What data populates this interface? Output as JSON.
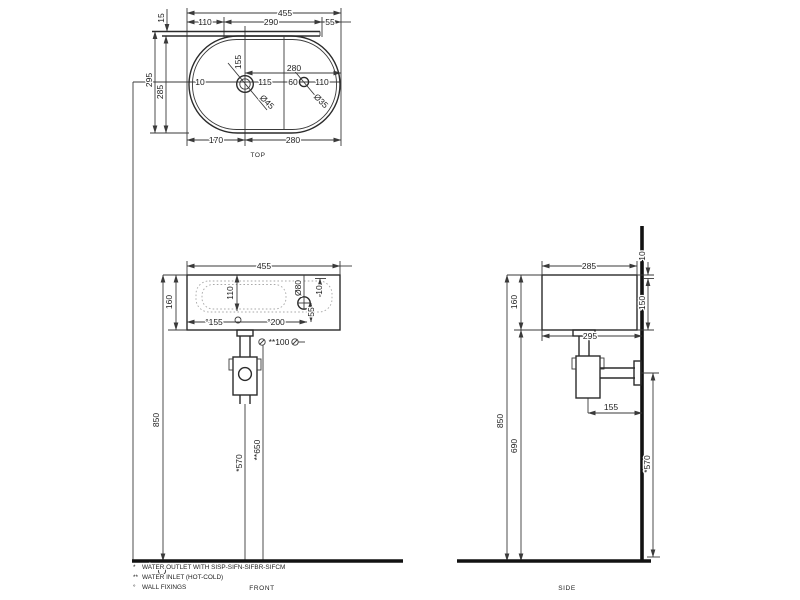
{
  "views": {
    "top": {
      "label": "TOP",
      "dims": {
        "width": "455",
        "back_left": "110",
        "back_mid": "290",
        "back_right": "55",
        "ledge": "15",
        "depth_overall": "295",
        "depth_basin": "285",
        "rim": "10",
        "drain_offset": "155",
        "drain_to_line": "115",
        "line_to_tap": "60",
        "tap_to_edge": "110",
        "drain_to_edge": "280",
        "drain_dia": "Ø45",
        "tap_dia": "Ø35",
        "edge_to_drain": "170",
        "drain_to_edge_bottom": "280"
      }
    },
    "front": {
      "label": "FRONT",
      "dims": {
        "width": "455",
        "height": "160",
        "bowl_depth": "110",
        "overflow_dia": "Ø80",
        "overflow_drop": "55",
        "rim": "10",
        "fixing_left": "°155",
        "fixing_right": "°200",
        "inlet_pitch": "**100",
        "rim_height": "850",
        "outlet_height": "*570",
        "inlet_height": "**650"
      }
    },
    "side": {
      "label": "SIDE",
      "dims": {
        "depth": "285",
        "height": "160",
        "top_gap": "10",
        "wall_drop": "150",
        "depth_overall": "295",
        "trap_to_wall": "155",
        "rim_height": "850",
        "underside_height": "690",
        "outlet_height": "*570"
      }
    }
  },
  "notes": [
    {
      "marker": "*",
      "text": "WATER OUTLET WITH SISP-SIFN-SIFBR-SIFCM"
    },
    {
      "marker": "**",
      "text": "WATER INLET  (HOT-COLD)"
    },
    {
      "marker": "°",
      "text": "WALL FIXINGS"
    }
  ]
}
